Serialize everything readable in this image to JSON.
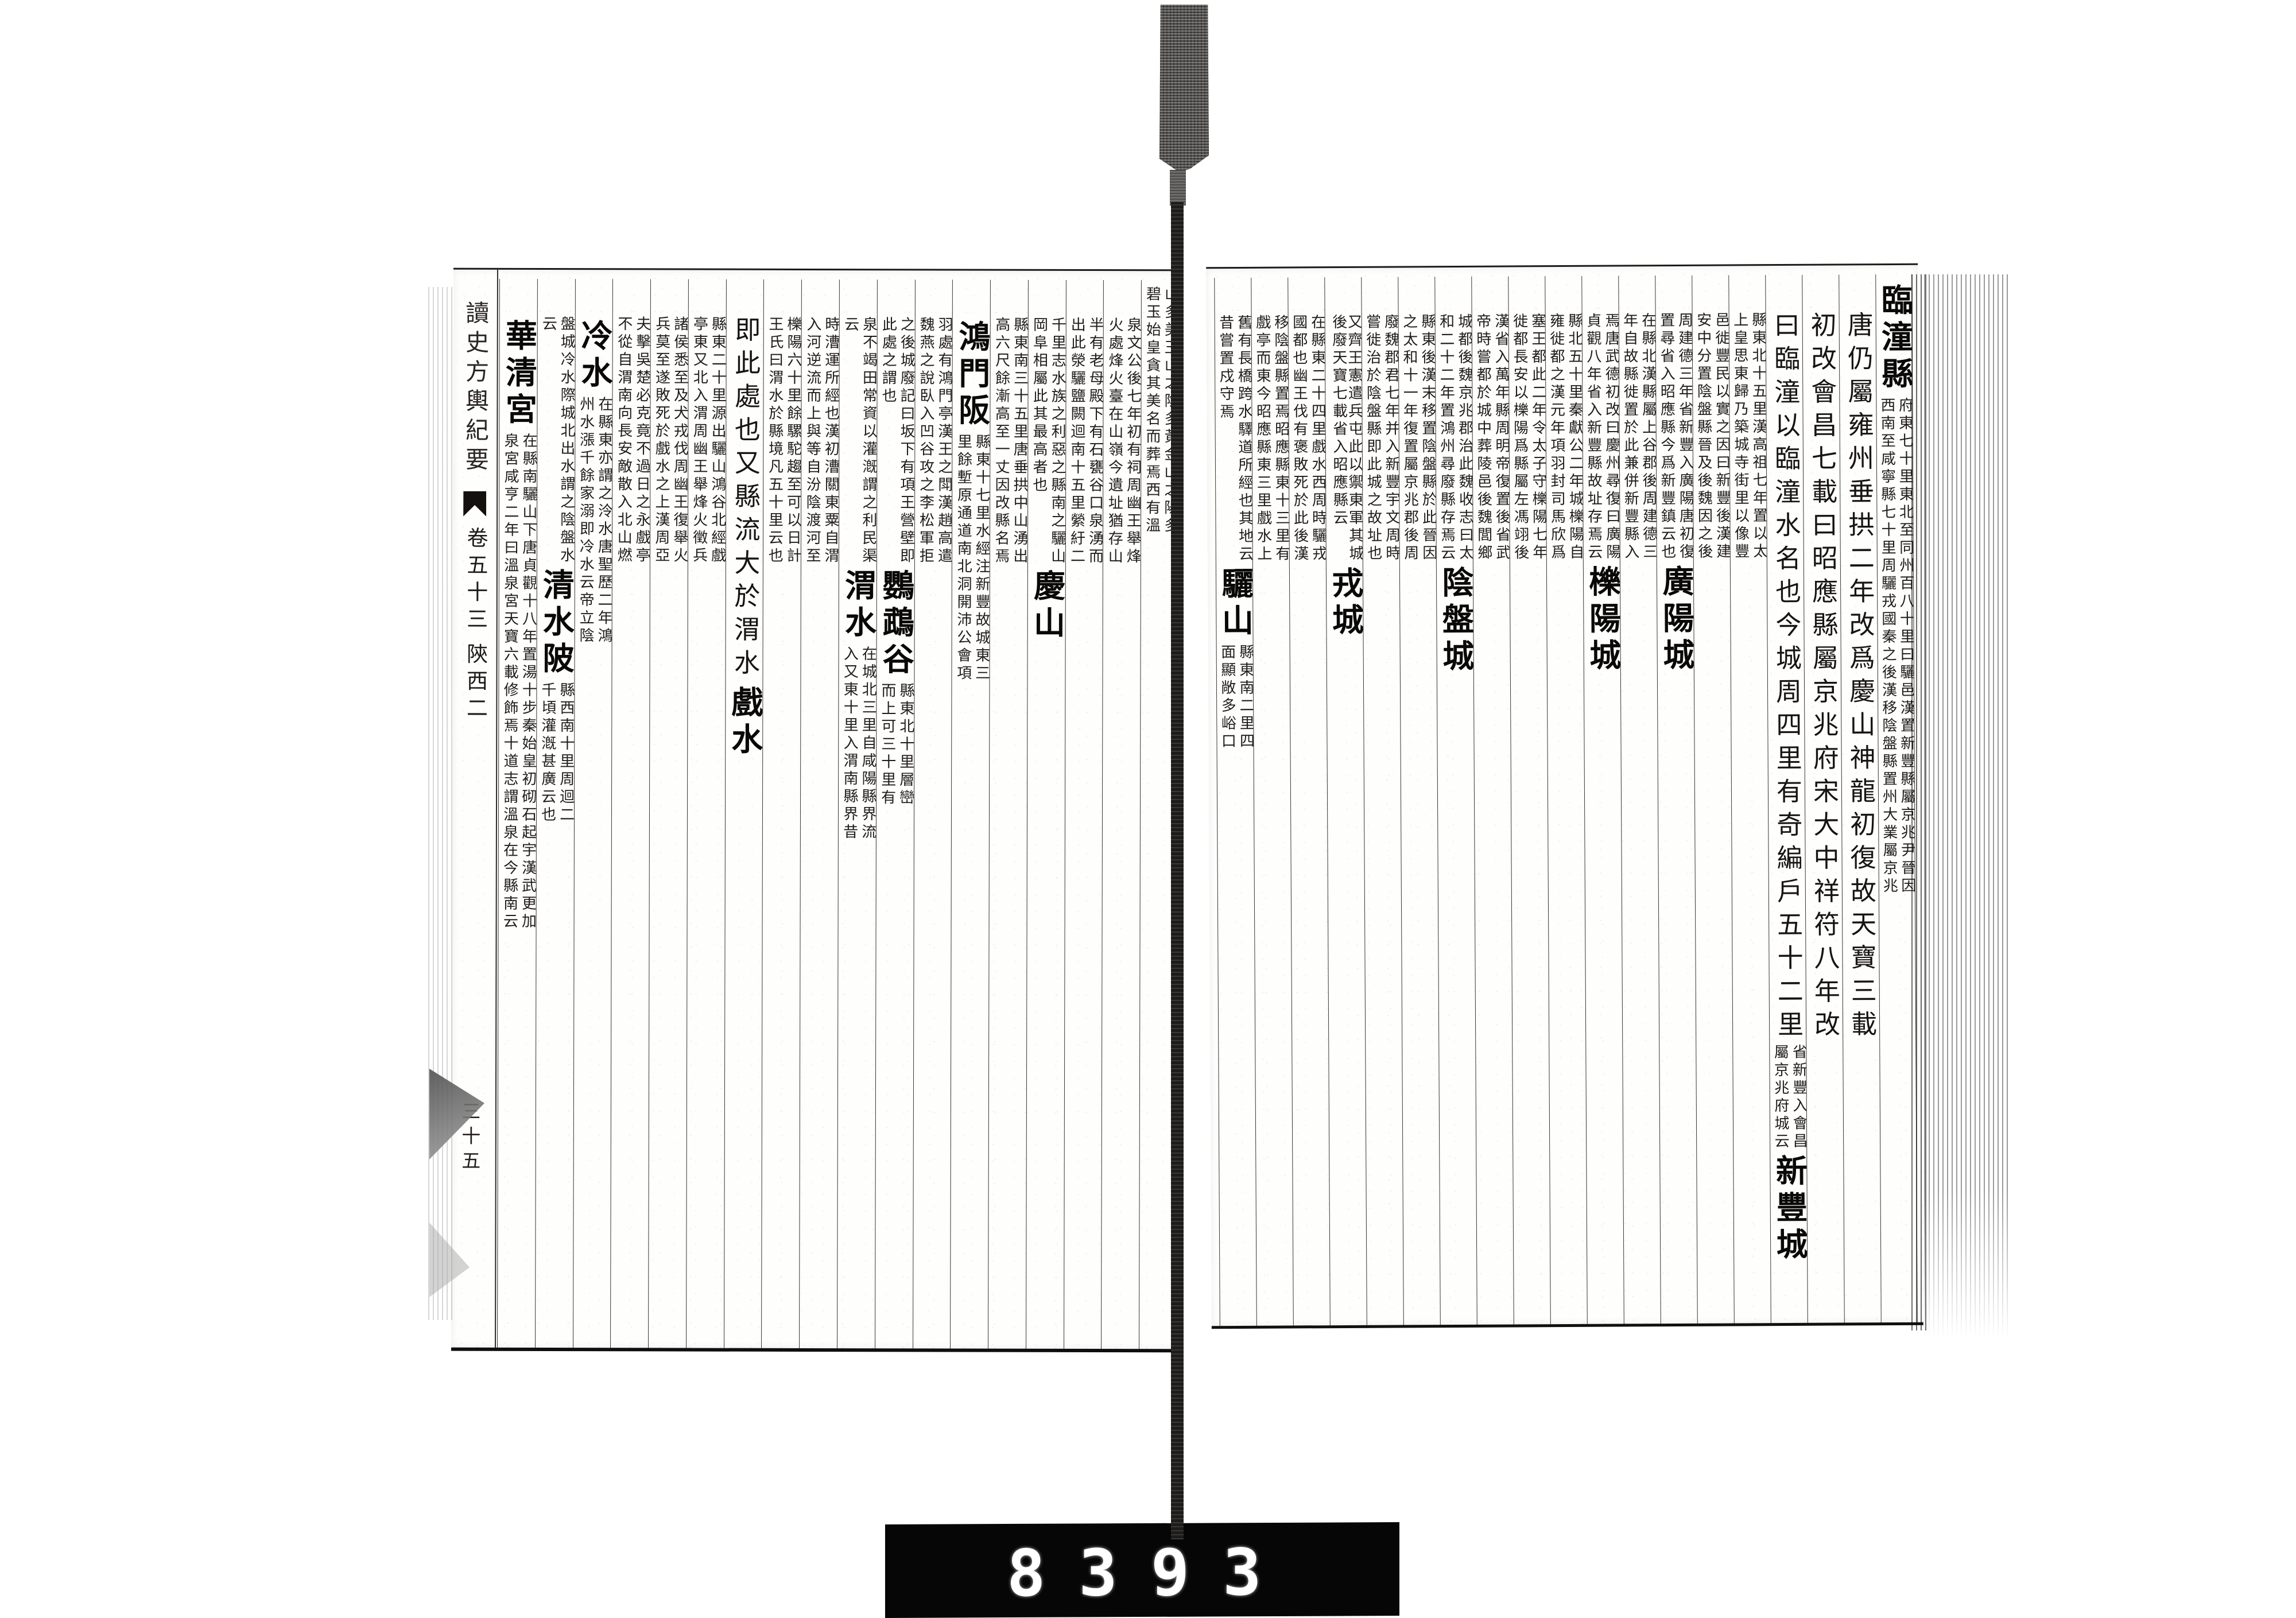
{
  "banxin": {
    "title": "讀史方輿紀要",
    "juan": "卷五十三",
    "section": "陝西二",
    "folio": "三十五"
  },
  "counter": {
    "frame_number": "8393"
  },
  "right_page": {
    "columns": [
      {
        "segments": [
          {
            "h": "臨潼縣"
          },
          {
            "n": [
              "府東七十里東北至同州百八十里",
              "西南至咸寧縣七十里周驪戎國秦"
            ]
          },
          {
            "n": [
              "曰驪邑漢置新豐縣屬京兆尹晉因",
              "之後漢移陰盤縣置州大業屬京兆"
            ]
          }
        ]
      },
      {
        "segments": [
          {
            "b": "唐仍屬雍州垂拱二年改爲慶山神龍初復故天寶三載"
          }
        ]
      },
      {
        "segments": [
          {
            "b": "初改會昌七載曰昭應縣屬京兆府宋大中祥符八年改"
          }
        ]
      },
      {
        "segments": [
          {
            "b": "曰臨潼以臨潼水名也今城周四里有奇編戶五十二里"
          },
          {
            "n": [
              "省新豐入會昌",
              "屬京兆府城云"
            ]
          },
          {
            "h": "新豐城"
          }
        ]
      },
      {
        "segments": [
          {
            "n": [
              "縣東北十五里漢高祖七年置以太",
              "上皇思東歸乃築城寺街里以像豐"
            ]
          }
        ]
      },
      {
        "segments": [
          {
            "n": [
              "邑徙豐民以實之因曰新豐後漢建",
              "安中分置陰盤縣晉及後魏因之後"
            ]
          }
        ]
      },
      {
        "segments": [
          {
            "n": [
              "周建德三年省新豐入廣陽唐初復",
              "置尋省入昭應縣今爲新豐鎮云也"
            ]
          },
          {
            "h": "廣陽城"
          }
        ]
      },
      {
        "segments": [
          {
            "n": [
              "在縣北漢縣屬上谷郡後周建德三",
              "年自故縣徙置於此兼併新豐縣入"
            ]
          }
        ]
      },
      {
        "segments": [
          {
            "n": [
              "焉唐武德初改曰慶州尋復曰廣陽",
              "貞觀八年省入新豐縣故址存焉云"
            ]
          },
          {
            "h": "櫟陽城"
          }
        ]
      },
      {
        "segments": [
          {
            "n": [
              "縣北五十里秦獻公二年城櫟陽自",
              "雍徙都之漢元年項羽封司馬欣爲"
            ]
          }
        ]
      },
      {
        "segments": [
          {
            "n": [
              "塞王都此二年令太子守櫟陽七年",
              "徙都長安以櫟陽爲縣屬左馮翊後"
            ]
          }
        ]
      },
      {
        "segments": [
          {
            "n": [
              "漢省入萬年縣周明帝復置後省武",
              "帝時嘗都於城中葬陵邑後魏閭鄉"
            ]
          }
        ]
      },
      {
        "segments": [
          {
            "n": [
              "城都後魏京兆郡治此魏收志曰太",
              "和二十二年置鴻州尋廢縣存焉云"
            ]
          },
          {
            "h": "陰盤城"
          }
        ]
      },
      {
        "segments": [
          {
            "n": [
              "縣東後漢末移置陰盤縣於此晉因",
              "之太和十一年復置屬京兆郡後周"
            ]
          }
        ]
      },
      {
        "segments": [
          {
            "n": [
              "廢魏郡君七年并入新豐宇文周時",
              "嘗徙治於陰盤縣即此城之故址也"
            ]
          }
        ]
      },
      {
        "segments": [
          {
            "n": [
              "又齊王憲遣兵屯此以禦東軍其城",
              "後廢天寶七載省入昭應縣云",
              "  "
            ]
          },
          {
            "h": "戎城"
          }
        ]
      },
      {
        "segments": [
          {
            "n": [
              "在縣東二十四里戲水西周時驪戎",
              "國都也幽王伐有褒敗死於此後漢"
            ]
          }
        ]
      },
      {
        "segments": [
          {
            "n": [
              "移陰盤縣置焉昭應縣東十三里有",
              "戲亭而東今昭應縣東三里戲水上"
            ]
          }
        ]
      },
      {
        "segments": [
          {
            "n": [
              "舊有長橋跨水驛道所經也其地云",
              "昔嘗置戍守焉"
            ]
          },
          {
            "h": "驪山"
          },
          {
            "n": [
              "縣東南二里四",
              "面顯敞多峪口"
            ]
          }
        ]
      }
    ]
  },
  "left_page": {
    "columns": [
      {
        "segments": [
          {
            "n": [
              "山多美玉山之陰多黃金山之陽多",
              "碧玉始皇貪其美名而葬焉西有溫"
            ]
          }
        ]
      },
      {
        "segments": [
          {
            "n": [
              "泉文公後七年初有祠周幽王舉烽",
              "火處烽火臺在山嶺今遺址猶存山"
            ]
          }
        ]
      },
      {
        "segments": [
          {
            "n": [
              "半有老母殿下有石甕谷口泉湧而",
              "出此滎驪鹽闕迴南十五里縈紆二"
            ]
          }
        ]
      },
      {
        "segments": [
          {
            "n": [
              "千里志水族之利惡之縣南之驪山",
              "岡阜相屬此其最高者也"
            ]
          },
          {
            "h": "慶山"
          }
        ]
      },
      {
        "segments": [
          {
            "n": [
              "縣東南三十五里唐垂拱中山湧出",
              "高六尺餘漸高至一丈因改縣名焉"
            ]
          }
        ]
      },
      {
        "segments": [
          {
            "h": "鴻門阪"
          },
          {
            "n": [
              "縣東十七里水經注新豐故城東三",
              "里餘塹原通道南北洞開沛公會項"
            ]
          }
        ]
      },
      {
        "segments": [
          {
            "n": [
              "羽處有鴻門亭漢王之閗漢趙高遣",
              "魏燕之說臥入凹谷攻之李松軍拒"
            ]
          }
        ]
      },
      {
        "segments": [
          {
            "n": [
              "之後城廢記曰坂下有項王營壁即",
              "此處之謂也"
            ]
          },
          {
            "h": "鸚鵡谷"
          },
          {
            "n": [
              "縣東北十里層巒",
              "而上可三十里有"
            ]
          }
        ]
      },
      {
        "segments": [
          {
            "n": [
              "泉不竭田常資以灌漑謂之利民渠",
              "云"
            ]
          },
          {
            "h": "渭水"
          },
          {
            "n": [
              "在城北三里自咸陽縣界流",
              "入又東十里入渭南縣界昔"
            ]
          }
        ]
      },
      {
        "segments": [
          {
            "n": [
              "時漕運所經也漢初漕關東粟自渭",
              "入河逆流而上與等自汾陰渡河至"
            ]
          }
        ]
      },
      {
        "segments": [
          {
            "n": [
              "櫟陽六十里餘騾駝趨至可以日計",
              "王氏曰渭水於縣境凡五十里云也"
            ]
          }
        ]
      },
      {
        "segments": [
          {
            "b": "即此處也又縣流大於渭水"
          },
          {
            "h": "戲水"
          }
        ]
      },
      {
        "segments": [
          {
            "n": [
              "縣東二十里源出驪山鴻谷北經戲",
              "亭東又北入渭周幽王舉烽火徵兵"
            ]
          }
        ]
      },
      {
        "segments": [
          {
            "n": [
              "諸侯悉至及犬戎伐周幽王復舉火",
              "兵莫至遂敗死於戲水之上漢周亞"
            ]
          }
        ]
      },
      {
        "segments": [
          {
            "n": [
              "夫擊吳楚必克竟不過日之永戲亭",
              "不從自渭南向長安敵散入北山燃"
            ]
          }
        ]
      },
      {
        "segments": [
          {
            "h": "冷水"
          },
          {
            "n": [
              "在縣東亦謂之泠水唐聖歷二年鴻",
              "州水漲千餘家溺即冷水云帝立陰"
            ]
          }
        ]
      },
      {
        "segments": [
          {
            "n": [
              "盤城冷水際城北出水謂之陰盤水",
              "云"
            ]
          },
          {
            "h": "清水陂"
          },
          {
            "n": [
              "縣西南十里周迴二",
              "千頃灌漑甚廣云也"
            ]
          }
        ]
      },
      {
        "segments": [
          {
            "h": "華清宮"
          },
          {
            "n": [
              "在縣南驪山下唐貞觀十八年置湯",
              "泉宮咸亨二年曰溫泉宮天寶六載"
            ]
          },
          {
            "n": [
              "十步秦始皇初砌石起宇漢武更加",
              "修飾焉十道志謂溫泉在今縣南云"
            ]
          }
        ]
      }
    ]
  }
}
